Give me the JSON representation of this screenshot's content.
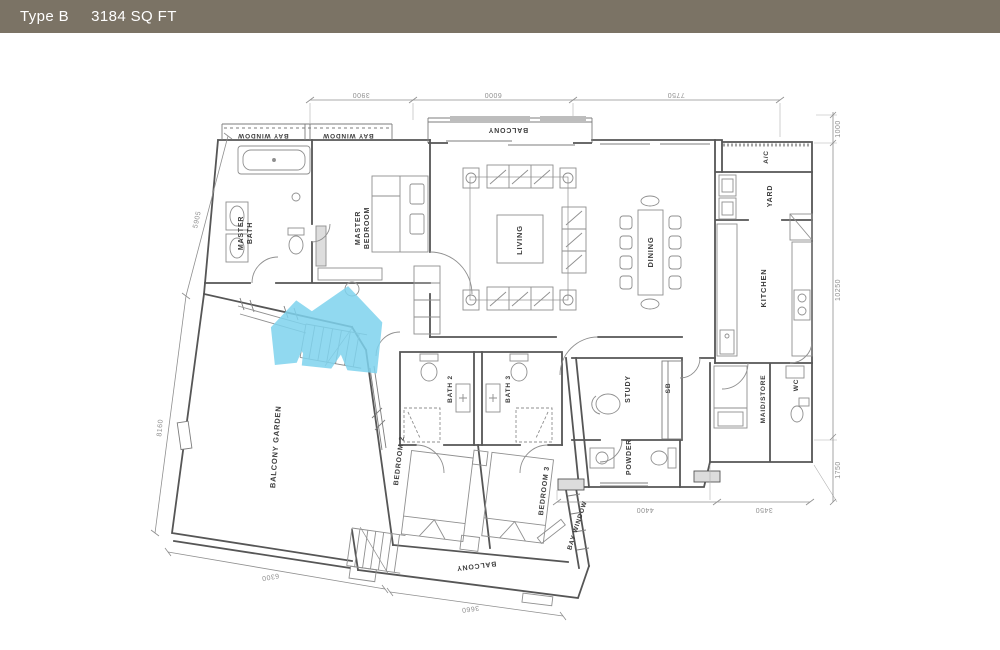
{
  "header": {
    "type_label": "Type B",
    "area_label": "3184 SQ FT"
  },
  "colors": {
    "header_bg": "#7b7365",
    "header_text": "#ffffff",
    "wall": "#565656",
    "fixture": "#8f8f8f",
    "dimension": "#9a9a9a",
    "room_label": "#3c3c3c",
    "logo_blue": "#7ed3ee",
    "background": "#ffffff"
  },
  "rooms": {
    "bay_window_left": "BAY WINDOW",
    "bay_window_right": "BAY WINDOW",
    "balcony_top": "BALCONY",
    "master_bath": {
      "line1": "MASTER",
      "line2": "BATH"
    },
    "master_bedroom": {
      "line1": "MASTER",
      "line2": "BEDROOM"
    },
    "living": "LIVING",
    "dining": "DINING",
    "ac": "A/C",
    "yard": "YARD",
    "kitchen": "KITCHEN",
    "maid_store": "MAID/STORE",
    "wc": "WC",
    "study": "STUDY",
    "sb": "SB",
    "powder": "POWDER",
    "bath2": "BATH 2",
    "bath3": "BATH 3",
    "bedroom2": "BEDROOM 2",
    "bedroom3": "BEDROOM 3",
    "balcony_garden": "BALCONY GARDEN",
    "balcony_bottom": "BALCONY",
    "bay_window_bottom": "BAY WINDOW"
  },
  "dimensions": {
    "top": [
      "3900",
      "6000",
      "7750"
    ],
    "right": [
      "1000",
      "10250",
      "1750"
    ],
    "left": [
      "5905",
      "8160"
    ],
    "bottom": [
      "6300",
      "3660"
    ],
    "bottom_right": [
      "4400",
      "3450"
    ]
  },
  "logo": {
    "name": "twin-house-logo"
  }
}
